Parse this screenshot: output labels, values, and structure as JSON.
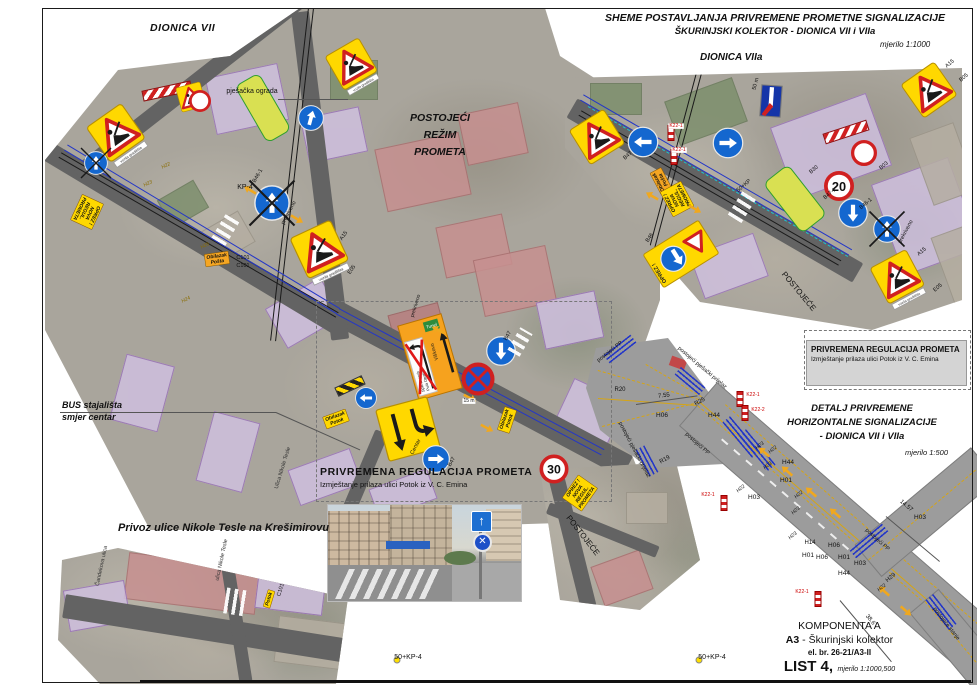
{
  "sheet": {
    "title_line1": "SHEME POSTAVLJANJA PRIVREMENE PROMETNE SIGNALIZACIJE",
    "title_line2": "ŠKURINJSKI KOLEKTOR - DIONICA VII i VIIa",
    "scale": "mjerilo 1:1000",
    "section_vii": "DIONICA VII",
    "section_viia": "DIONICA VIIa",
    "existing_line1": "POSTOJEĆI",
    "existing_line2": "REŽIM",
    "existing_line3": "PROMETA",
    "bus_line1": "BUS stajališta",
    "bus_line2": "smjer centar",
    "privoz": "Privoz ulice Nikole Tesle na Krešimirovu",
    "temp_reg_title": "PRIVREMENA REGULACIJA PROMETA",
    "temp_reg_sub": "Izmještanje prilaza ulici Potok iz V. C. Emina",
    "detail_line1": "DETALJ PRIVREMENE",
    "detail_line2": "HORIZONTALNE SIGNALIZACIJE",
    "detail_line3": "- DIONICA VII i VIIa",
    "detail_scale": "mjerilo 1:500",
    "komponenta": "KOMPONENTA A",
    "komponenta_a3": "A3",
    "komponenta_rest": " - Škurinjski kolektor",
    "el_br": "el. br. 26-21/A3-II",
    "list_no": "LIST 4,",
    "list_scale": "mjerilo 1:1000,500"
  },
  "colors": {
    "accent_yellow": "#ffd800",
    "accent_blue": "#1467cf",
    "line_blue": "#2336c8",
    "road_gray": "#9c9c9c",
    "warn_red": "#d02020",
    "overlay_purple": "#cfc0df"
  },
  "labels": [
    {
      "t": "pješačka ograda",
      "x": 252,
      "y": 92,
      "s": 7
    },
    {
      "t": "KP-4",
      "x": 245,
      "y": 188,
      "s": 7
    },
    {
      "t": "B46-1",
      "x": 258,
      "y": 176,
      "s": 5.5,
      "r": -60
    },
    {
      "t": "prekriveno",
      "x": 289,
      "y": 213,
      "s": 5.5,
      "r": -62
    },
    {
      "t": "prekriveno",
      "x": 416,
      "y": 306,
      "s": 5,
      "r": -73
    },
    {
      "t": "A15",
      "x": 344,
      "y": 236,
      "s": 5.5,
      "r": -55
    },
    {
      "t": "E05",
      "x": 352,
      "y": 270,
      "s": 5.5,
      "r": -55
    },
    {
      "t": "C101",
      "x": 243,
      "y": 258,
      "s": 5.5
    },
    {
      "t": "C101",
      "x": 243,
      "y": 266,
      "s": 5.5
    },
    {
      "t": "H22",
      "x": 166,
      "y": 166,
      "s": 5,
      "i": 1,
      "r": -25,
      "c": "#8a6d00"
    },
    {
      "t": "H23",
      "x": 148,
      "y": 184,
      "s": 5,
      "i": 1,
      "r": -25,
      "c": "#8a6d00"
    },
    {
      "t": "H24",
      "x": 186,
      "y": 300,
      "s": 5,
      "i": 1,
      "r": -25,
      "c": "#8a6d00"
    },
    {
      "t": "H26",
      "x": 205,
      "y": 246,
      "s": 5,
      "i": 1,
      "r": -25,
      "c": "#8a6d00"
    },
    {
      "t": "Ulica Nikole Tesle",
      "x": 283,
      "y": 468,
      "s": 5.5,
      "r": -73,
      "c": "#333"
    },
    {
      "t": "B47",
      "x": 452,
      "y": 462,
      "s": 5.5,
      "r": -60
    },
    {
      "t": "B47",
      "x": 508,
      "y": 336,
      "s": 5.5,
      "r": -60
    },
    {
      "t": "15 m",
      "x": 469,
      "y": 401,
      "s": 5,
      "bg": "#fff"
    },
    {
      "t": "Centar",
      "x": 416,
      "y": 447,
      "s": 5.5,
      "r": -62
    },
    {
      "t": "POSTOJEĆE",
      "x": 582,
      "y": 536,
      "s": 8,
      "r": 52
    },
    {
      "t": "50+KP-4",
      "x": 408,
      "y": 658,
      "s": 7
    },
    {
      "t": "50+KP-4",
      "x": 712,
      "y": 658,
      "s": 7
    },
    {
      "t": "ulica Nikole Tesle",
      "x": 222,
      "y": 560,
      "s": 5.5,
      "r": -78,
      "c": "#333"
    },
    {
      "t": "Čandekova ulica",
      "x": 102,
      "y": 566,
      "s": 5.5,
      "r": -78,
      "c": "#333"
    },
    {
      "t": "C101",
      "x": 281,
      "y": 590,
      "s": 5.5,
      "r": -73
    },
    {
      "t": "POSTOJEĆE",
      "x": 798,
      "y": 292,
      "s": 8,
      "r": 50
    },
    {
      "t": "B30",
      "x": 814,
      "y": 170,
      "s": 5.5,
      "r": -40
    },
    {
      "t": "B47-1",
      "x": 830,
      "y": 194,
      "s": 5.5,
      "r": -40
    },
    {
      "t": "B46-1",
      "x": 866,
      "y": 204,
      "s": 5.5,
      "r": -40
    },
    {
      "t": "prekriveno",
      "x": 906,
      "y": 232,
      "s": 5.5,
      "r": -62
    },
    {
      "t": "B03",
      "x": 884,
      "y": 166,
      "s": 5.5,
      "r": -40
    },
    {
      "t": "A15",
      "x": 922,
      "y": 252,
      "s": 5.5,
      "r": -40
    },
    {
      "t": "E05",
      "x": 938,
      "y": 288,
      "s": 5.5,
      "r": -40
    },
    {
      "t": "A15",
      "x": 950,
      "y": 64,
      "s": 5.5,
      "r": -40
    },
    {
      "t": "B05",
      "x": 964,
      "y": 78,
      "s": 5.5,
      "r": -40
    },
    {
      "t": "50 m",
      "x": 756,
      "y": 84,
      "s": 5.5,
      "r": -75
    },
    {
      "t": "K22-1",
      "x": 676,
      "y": 126,
      "s": 5,
      "c": "#cc0000",
      "bg": "#fff"
    },
    {
      "t": "K22-1",
      "x": 679,
      "y": 150,
      "s": 5,
      "c": "#cc0000",
      "bg": "#fff"
    },
    {
      "t": "50+KP",
      "x": 744,
      "y": 186,
      "s": 5.5,
      "r": -40
    },
    {
      "t": "B47",
      "x": 628,
      "y": 156,
      "s": 5.5,
      "r": -40
    },
    {
      "t": "B46",
      "x": 650,
      "y": 238,
      "s": 5.5,
      "r": -55
    },
    {
      "t": "R20",
      "x": 620,
      "y": 390,
      "s": 6
    },
    {
      "t": "7.55",
      "x": 664,
      "y": 396,
      "s": 6,
      "r": -8
    },
    {
      "t": "R25",
      "x": 700,
      "y": 402,
      "s": 6,
      "r": -30
    },
    {
      "t": "H06",
      "x": 662,
      "y": 416,
      "s": 6.5
    },
    {
      "t": "H44",
      "x": 714,
      "y": 416,
      "s": 6.5
    },
    {
      "t": "K22-1",
      "x": 753,
      "y": 395,
      "s": 5,
      "c": "#cc0000"
    },
    {
      "t": "K22-2",
      "x": 758,
      "y": 410,
      "s": 5,
      "c": "#cc0000"
    },
    {
      "t": "R19",
      "x": 665,
      "y": 460,
      "s": 6,
      "r": -30
    },
    {
      "t": "postojeći PP",
      "x": 697,
      "y": 444,
      "s": 5.5,
      "r": 42
    },
    {
      "t": "postojeći PP",
      "x": 610,
      "y": 352,
      "s": 5.5,
      "r": -38
    },
    {
      "t": "postojeći pješački prijelaz",
      "x": 702,
      "y": 368,
      "s": 5.5,
      "r": 40
    },
    {
      "t": "postojeći pješački prijelaz",
      "x": 634,
      "y": 450,
      "s": 5.5,
      "r": 62
    },
    {
      "t": "H23",
      "x": 760,
      "y": 446,
      "s": 5,
      "i": 1,
      "r": -40
    },
    {
      "t": "H22",
      "x": 773,
      "y": 450,
      "s": 5,
      "i": 1,
      "r": -40
    },
    {
      "t": "H23",
      "x": 768,
      "y": 466,
      "s": 5,
      "i": 1,
      "r": -40
    },
    {
      "t": "H44",
      "x": 788,
      "y": 463,
      "s": 6.5
    },
    {
      "t": "H01",
      "x": 786,
      "y": 481,
      "s": 6.5
    },
    {
      "t": "H03",
      "x": 754,
      "y": 498,
      "s": 6.5
    },
    {
      "t": "K22-1",
      "x": 708,
      "y": 495,
      "s": 5,
      "c": "#cc0000"
    },
    {
      "t": "H22",
      "x": 741,
      "y": 489,
      "s": 5,
      "i": 1,
      "r": -40
    },
    {
      "t": "H22",
      "x": 799,
      "y": 495,
      "s": 5,
      "i": 1,
      "r": -40
    },
    {
      "t": "H23",
      "x": 796,
      "y": 511,
      "s": 5,
      "i": 1,
      "r": -40
    },
    {
      "t": "H23",
      "x": 793,
      "y": 536,
      "s": 5,
      "i": 1,
      "r": -40
    },
    {
      "t": "H14",
      "x": 810,
      "y": 543,
      "s": 6
    },
    {
      "t": "H06",
      "x": 834,
      "y": 546,
      "s": 6.5
    },
    {
      "t": "H06",
      "x": 822,
      "y": 558,
      "s": 6.5
    },
    {
      "t": "H01",
      "x": 808,
      "y": 556,
      "s": 6.5
    },
    {
      "t": "H01",
      "x": 844,
      "y": 558,
      "s": 6.5
    },
    {
      "t": "H03",
      "x": 860,
      "y": 564,
      "s": 6.5
    },
    {
      "t": "H03",
      "x": 920,
      "y": 518,
      "s": 6.5
    },
    {
      "t": "14.57",
      "x": 906,
      "y": 506,
      "s": 6,
      "r": 40
    },
    {
      "t": "H29",
      "x": 891,
      "y": 578,
      "s": 6,
      "r": -40
    },
    {
      "t": "H44",
      "x": 844,
      "y": 574,
      "s": 6.5
    },
    {
      "t": "H22",
      "x": 882,
      "y": 588,
      "s": 5,
      "i": 1,
      "r": -40
    },
    {
      "t": "K22-1",
      "x": 802,
      "y": 592,
      "s": 5,
      "c": "#cc0000"
    },
    {
      "t": "38.6",
      "x": 870,
      "y": 620,
      "s": 6,
      "r": 50
    },
    {
      "t": "postojeći PP",
      "x": 877,
      "y": 540,
      "s": 5.5,
      "r": 42
    },
    {
      "t": "postojeće stanje",
      "x": 946,
      "y": 624,
      "s": 5.5,
      "r": 52
    }
  ],
  "signs": [
    {
      "type": "roadworks",
      "x": 118,
      "y": 136,
      "w": 44,
      "rot": -35,
      "strip": "vozila gradilišta"
    },
    {
      "type": "barrier",
      "x": 167,
      "y": 91,
      "w": 48,
      "h": 9,
      "rot": -12
    },
    {
      "type": "roadworks",
      "x": 191,
      "y": 97,
      "w": 26,
      "rot": -15
    },
    {
      "type": "circle-empty",
      "x": 200,
      "y": 101,
      "w": 22
    },
    {
      "type": "blue-arrow",
      "x": 311,
      "y": 118,
      "w": 26,
      "dir": 15
    },
    {
      "type": "roadworks",
      "x": 353,
      "y": 67,
      "w": 40,
      "rot": -30,
      "strip": "vozila gradilišta"
    },
    {
      "type": "covered",
      "x": 96,
      "y": 163,
      "w": 24
    },
    {
      "type": "oprez-nova",
      "x": 87,
      "y": 212,
      "rot": 115,
      "lines": [
        "OPREZ !",
        "NOVA",
        "REGUL. PROMETA"
      ]
    },
    {
      "type": "obilazak",
      "x": 217,
      "y": 259,
      "rot": -8,
      "bg": "#f5a623",
      "lines": [
        "Obilazak",
        "Pošta"
      ]
    },
    {
      "type": "covered",
      "x": 272,
      "y": 203,
      "w": 36
    },
    {
      "type": "roadworks",
      "x": 321,
      "y": 253,
      "w": 46,
      "rot": -25,
      "strip": "vozila gradilišta"
    },
    {
      "type": "orange-dir",
      "x": 430,
      "y": 357,
      "rot": -16,
      "green": "Tunel",
      "right_city": "Viškovo",
      "left_top": "Split  Zagreb",
      "left_bottom": "Pula  Opatija"
    },
    {
      "type": "blue-arrow",
      "x": 501,
      "y": 351,
      "w": 30,
      "dir": 180
    },
    {
      "type": "no-stop",
      "x": 478,
      "y": 379,
      "w": 33
    },
    {
      "type": "blue-arrow",
      "x": 366,
      "y": 398,
      "w": 22,
      "dir": 270
    },
    {
      "type": "hazard-bar",
      "x": 350,
      "y": 386,
      "w": 28,
      "h": 8,
      "rot": -25
    },
    {
      "type": "detour",
      "x": 408,
      "y": 429,
      "w": 54,
      "rot": -15
    },
    {
      "type": "blue-arrow",
      "x": 436,
      "y": 459,
      "w": 28,
      "dir": 90
    },
    {
      "type": "obilazak",
      "x": 336,
      "y": 419,
      "rot": -20,
      "bg": "#ffd800",
      "lines": [
        "Obilazak",
        "Potok"
      ]
    },
    {
      "type": "obilazak",
      "x": 507,
      "y": 420,
      "rot": -72,
      "bg": "#ffd800",
      "lines": [
        "Obilazak",
        "Potok"
      ]
    },
    {
      "type": "speed",
      "x": 554,
      "y": 469,
      "w": 29,
      "value": "30"
    },
    {
      "type": "oprez-nova",
      "x": 580,
      "y": 493,
      "rot": -55,
      "lines": [
        "OPREZ !",
        "NOVA",
        "REGUL. PROMETA"
      ]
    },
    {
      "type": "roadworks",
      "x": 597,
      "y": 137,
      "w": 42,
      "rot": -32
    },
    {
      "type": "blue-arrow",
      "x": 643,
      "y": 142,
      "w": 31,
      "dir": 270
    },
    {
      "type": "blue-arrow",
      "x": 728,
      "y": 143,
      "w": 31,
      "dir": 90
    },
    {
      "type": "blue-flag",
      "x": 771,
      "y": 101,
      "w": 22,
      "h": 32,
      "rot": 4
    },
    {
      "type": "obilazak",
      "x": 661,
      "y": 181,
      "rot": -118,
      "bg": "#f5a623",
      "lines": [
        "Obilazak",
        "Pošta"
      ]
    },
    {
      "type": "oprez-nova",
      "x": 677,
      "y": 199,
      "rot": -118,
      "lines": [
        "OPREZ !",
        "NOVA",
        "REGUL. PROMETA"
      ]
    },
    {
      "type": "oprez-yield",
      "x": 681,
      "y": 254,
      "rot": -32,
      "label": "OPREZ !"
    },
    {
      "type": "bus-strip",
      "x": 795,
      "y": 199,
      "w": 30,
      "h": 62,
      "rot": -38
    },
    {
      "type": "bus-strip",
      "x": 263,
      "y": 108,
      "w": 26,
      "h": 64,
      "rot": -30
    },
    {
      "type": "barrier",
      "x": 846,
      "y": 132,
      "w": 44,
      "h": 9,
      "rot": -18
    },
    {
      "type": "circle-empty",
      "x": 864,
      "y": 153,
      "w": 26
    },
    {
      "type": "speed",
      "x": 839,
      "y": 186,
      "w": 30,
      "value": "20"
    },
    {
      "type": "blue-arrow",
      "x": 853,
      "y": 213,
      "w": 30,
      "dir": 180
    },
    {
      "type": "covered",
      "x": 887,
      "y": 229,
      "w": 28
    },
    {
      "type": "roadworks",
      "x": 899,
      "y": 280,
      "w": 42,
      "rot": -28,
      "strip": "vozila gradilišta"
    },
    {
      "type": "roadworks",
      "x": 929,
      "y": 90,
      "w": 42,
      "rot": -35
    },
    {
      "type": "obilazak",
      "x": 269,
      "y": 599,
      "rot": -73,
      "bg": "#ffd800",
      "lines": [
        "Potok"
      ]
    },
    {
      "type": "k22",
      "x": 740,
      "y": 399
    },
    {
      "type": "k22",
      "x": 745,
      "y": 413
    },
    {
      "type": "k22",
      "x": 724,
      "y": 503
    },
    {
      "type": "k22",
      "x": 818,
      "y": 599
    },
    {
      "type": "k22",
      "x": 671,
      "y": 133
    },
    {
      "type": "k22",
      "x": 674,
      "y": 157
    },
    {
      "type": "dot",
      "x": 397,
      "y": 660,
      "w": 5,
      "c": "#ffe000"
    },
    {
      "type": "dot",
      "x": 699,
      "y": 660,
      "w": 5,
      "c": "#ffe000"
    },
    {
      "type": "bluelines",
      "x": 620,
      "y": 349,
      "w": 34,
      "rot": -38
    },
    {
      "type": "bluelines",
      "x": 690,
      "y": 381,
      "w": 32,
      "rot": 40
    },
    {
      "type": "bluelines",
      "x": 741,
      "y": 437,
      "w": 46,
      "rot": 50
    },
    {
      "type": "bluelines",
      "x": 757,
      "y": 450,
      "w": 46,
      "rot": 50
    },
    {
      "type": "bluelines",
      "x": 869,
      "y": 541,
      "w": 42,
      "rot": -40
    },
    {
      "type": "bluelines",
      "x": 941,
      "y": 612,
      "w": 38,
      "rot": 52
    },
    {
      "type": "bluelines",
      "x": 647,
      "y": 461,
      "w": 30,
      "rot": 62
    },
    {
      "type": "yarrow",
      "x": 764,
      "y": 452,
      "rot": -139
    },
    {
      "type": "yarrow",
      "x": 787,
      "y": 471,
      "rot": -139
    },
    {
      "type": "yarrow",
      "x": 811,
      "y": 492,
      "rot": -139
    },
    {
      "type": "yarrow",
      "x": 835,
      "y": 513,
      "rot": -139
    },
    {
      "type": "yarrow",
      "x": 884,
      "y": 591,
      "rot": -139
    },
    {
      "type": "yarrow",
      "x": 906,
      "y": 611,
      "rot": 41
    },
    {
      "type": "yarrow",
      "x": 250,
      "y": 190,
      "rot": -149
    },
    {
      "type": "yarrow",
      "x": 297,
      "y": 219,
      "rot": 31
    },
    {
      "type": "yarrow",
      "x": 438,
      "y": 330,
      "rot": -152
    },
    {
      "type": "yarrow",
      "x": 470,
      "y": 398,
      "rot": 28
    },
    {
      "type": "yarrow",
      "x": 487,
      "y": 428,
      "rot": 28
    },
    {
      "type": "yarrow",
      "x": 652,
      "y": 196,
      "rot": -150
    },
    {
      "type": "yarrow",
      "x": 695,
      "y": 209,
      "rot": 30
    },
    {
      "type": "zebra",
      "x": 226,
      "y": 229,
      "w": 30,
      "h": 16,
      "rot": -59
    },
    {
      "type": "zebra",
      "x": 520,
      "y": 342,
      "w": 26,
      "h": 14,
      "rot": -60
    },
    {
      "type": "zebra",
      "x": 742,
      "y": 207,
      "w": 28,
      "h": 16,
      "rot": -58
    },
    {
      "type": "zebra",
      "x": 236,
      "y": 602,
      "w": 22,
      "h": 26,
      "rot": 9
    }
  ]
}
